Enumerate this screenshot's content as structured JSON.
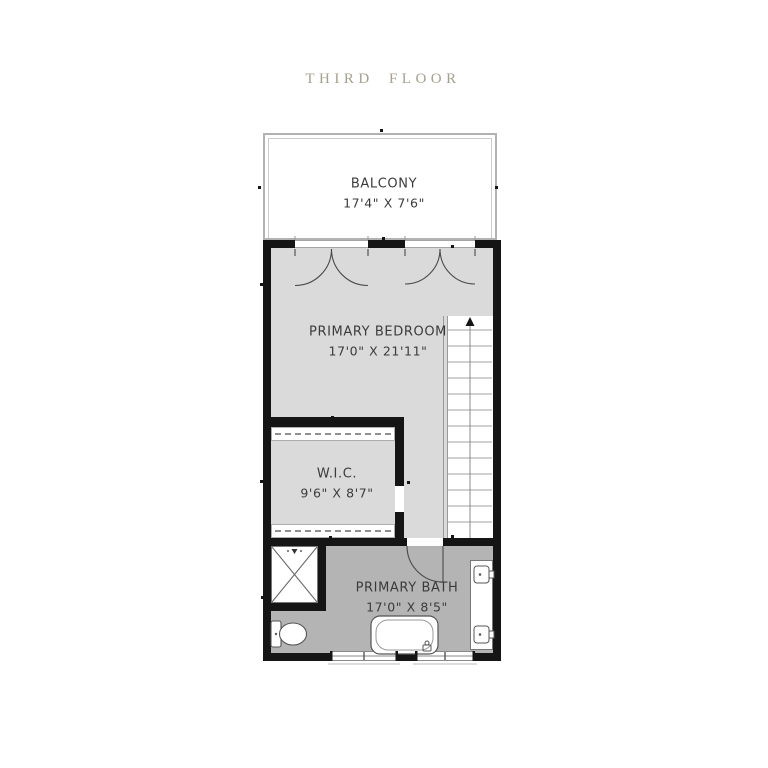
{
  "title": {
    "text": "THIRD FLOOR"
  },
  "rooms": {
    "balcony": {
      "name": "BALCONY",
      "dims": "17'4\" X 7'6\""
    },
    "bedroom": {
      "name": "PRIMARY BEDROOM",
      "dims": "17'0\" X 21'11\""
    },
    "wic": {
      "name": "W.I.C.",
      "dims": "9'6\" X 8'7\""
    },
    "bath": {
      "name": "PRIMARY BATH",
      "dims": "17'0\" X 8'5\""
    }
  },
  "colors": {
    "title_text": "#a6a08e",
    "wall": "#151515",
    "bedroom_floor": "#dadada",
    "bath_floor": "#b4b4b4",
    "balcony_border": "#b2b2b2",
    "label_text": "#3b3b3b",
    "fixture_stroke": "#555555"
  },
  "fixtures": [
    "balcony-railing",
    "french-doors-left",
    "french-doors-right",
    "stairs-up",
    "closet-rod-top",
    "closet-rod-bottom",
    "shower",
    "toilet",
    "bathtub",
    "double-vanity-sinks",
    "bath-door-swing",
    "windows",
    "wall-tick-markers"
  ]
}
